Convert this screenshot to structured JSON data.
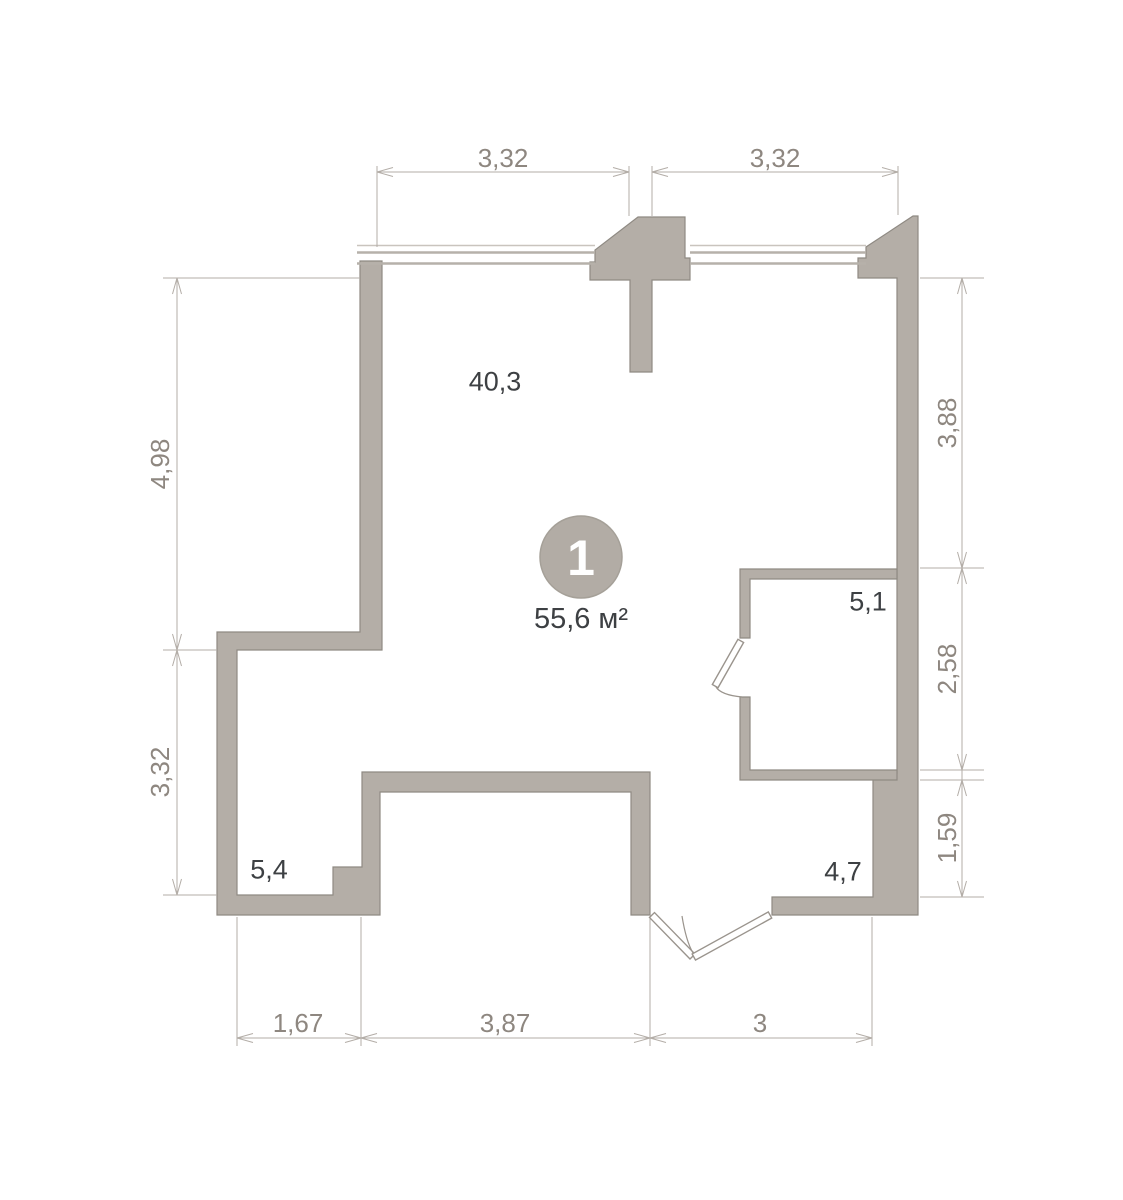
{
  "unit": {
    "number": "1",
    "area_label": "55,6 м²"
  },
  "rooms": [
    {
      "id": "main-room",
      "area": "40,3"
    },
    {
      "id": "storage-room",
      "area": "5,1"
    },
    {
      "id": "bottom-left-room",
      "area": "5,4"
    },
    {
      "id": "entry-hall",
      "area": "4,7"
    }
  ],
  "dimensions": {
    "top": [
      "3,32",
      "3,32"
    ],
    "left": [
      "4,98",
      "3,32"
    ],
    "right": [
      "3,88",
      "2,58",
      "1,59"
    ],
    "bottom": [
      "1,67",
      "3,87",
      "3"
    ]
  },
  "colors": {
    "wall_fill": "#b4aea7",
    "wall_outline": "#8f8a83",
    "dimension_line": "#b3ada7",
    "dimension_text": "#8e8780",
    "room_text": "#3d4043",
    "badge_fill": "#b2aca5",
    "badge_number": "#ffffff",
    "background": "#ffffff"
  }
}
